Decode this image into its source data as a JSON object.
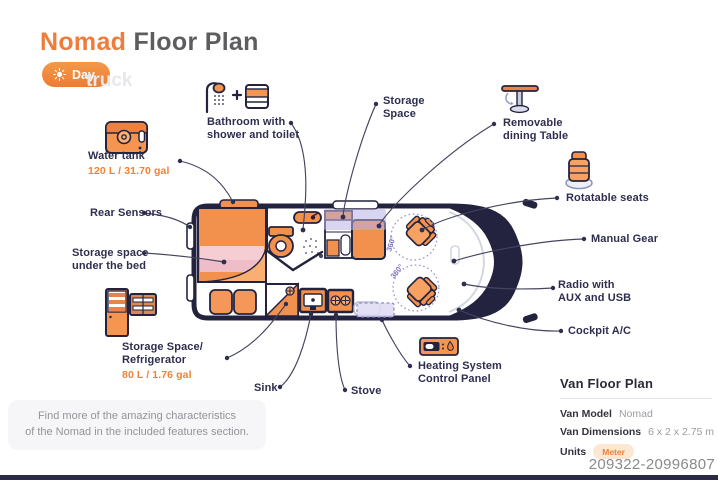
{
  "title": {
    "brand": "Nomad",
    "rest": " Floor Plan"
  },
  "mode_toggle": {
    "label": "Day",
    "icon": "sun-icon"
  },
  "watermark": {
    "word": "truck",
    "id": "209322-20996807"
  },
  "colors": {
    "accent_orange": "#F0813A",
    "outline_navy": "#23233F",
    "highlight_purple": "#7B74C9",
    "bed_pink": "#F2CAD1"
  },
  "van": {
    "rotation_badge": "360°"
  },
  "features": {
    "water_tank": {
      "label": "Water tank",
      "value": "120 L / 31.70 gal"
    },
    "rear_sensors": {
      "label": "Rear Sensors"
    },
    "storage_bed": {
      "line1": "Storage space",
      "line2": "under the bed"
    },
    "fridge": {
      "line1": "Storage Space/",
      "line2": "Refrigerator",
      "value": "80 L / 1.76 gal"
    },
    "bathroom": {
      "line1": "Bathroom with",
      "line2": "shower and toilet"
    },
    "storage_space": {
      "line1": "Storage",
      "line2": "Space"
    },
    "dining_table": {
      "line1": "Removable",
      "line2": "dining Table"
    },
    "rotatable_seats": {
      "label": "Rotatable seats"
    },
    "manual_gear": {
      "label": "Manual Gear"
    },
    "radio": {
      "line1": "Radio with",
      "line2": "AUX and USB"
    },
    "cockpit_ac": {
      "label": "Cockpit A/C"
    },
    "heating": {
      "line1": "Heating System",
      "line2": "Control Panel"
    },
    "sink": {
      "label": "Sink"
    },
    "stove": {
      "label": "Stove"
    }
  },
  "note": {
    "line1": "Find more of the amazing characteristics",
    "line2": "of the Nomad in the included features section."
  },
  "info_panel": {
    "title": "Van Floor Plan",
    "rows": [
      {
        "label": "Van Model",
        "value": "Nomad"
      },
      {
        "label": "Van Dimensions",
        "value": "6 x 2 x 2.75 m"
      },
      {
        "label": "Units",
        "value": "Meter"
      }
    ]
  }
}
